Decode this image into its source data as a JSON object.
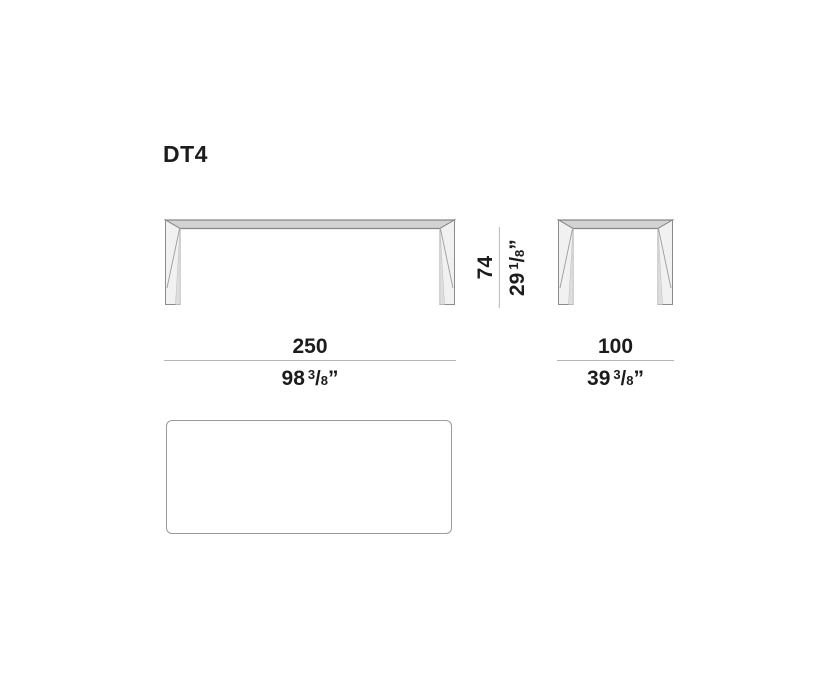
{
  "title": "DT4",
  "dimensions": {
    "width": {
      "cm": "250",
      "in": "98",
      "num": "3",
      "slash": "/",
      "den": "8",
      "mark": "”"
    },
    "depth": {
      "cm": "100",
      "in": "39",
      "num": "3",
      "slash": "/",
      "den": "8",
      "mark": "”"
    },
    "height": {
      "cm": "74",
      "in": "29",
      "num": "1",
      "slash": "/",
      "den": "8",
      "mark": "”"
    }
  },
  "colors": {
    "background": "#ffffff",
    "text": "#1c1c1c",
    "outline": "#8b8b8b",
    "tabletop_fill": "#d3d3d3",
    "leg_fill": "#f1f1f1",
    "leg_shade": "#dedede",
    "dimension_line": "#b5b5b5"
  }
}
